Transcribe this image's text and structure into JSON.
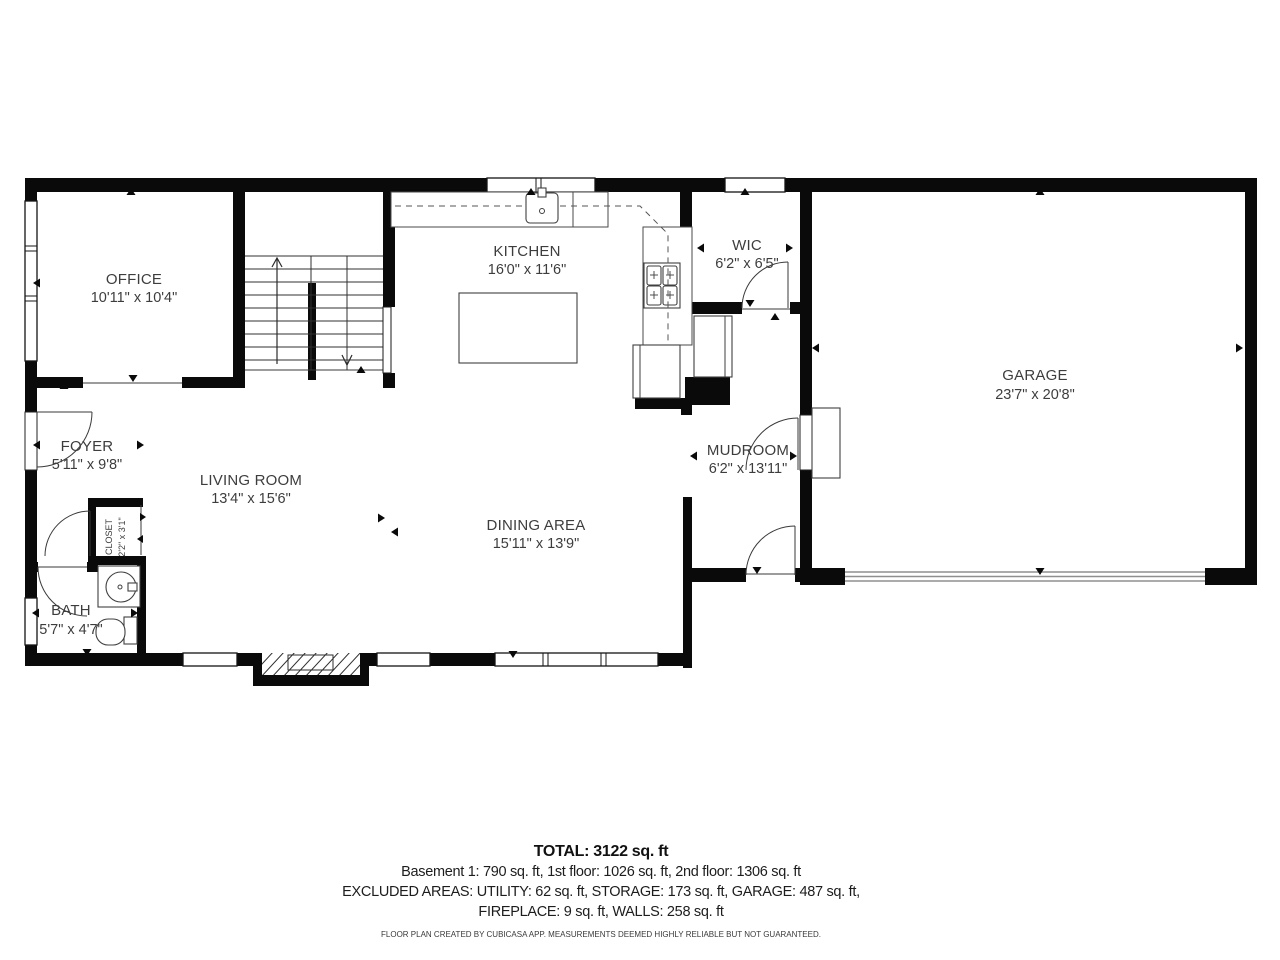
{
  "rooms": {
    "office": {
      "name": "OFFICE",
      "dims": "10'11\" x 10'4\""
    },
    "kitchen": {
      "name": "KITCHEN",
      "dims": "16'0\" x 11'6\""
    },
    "wic": {
      "name": "WIC",
      "dims": "6'2\" x 6'5\""
    },
    "garage": {
      "name": "GARAGE",
      "dims": "23'7\" x 20'8\""
    },
    "foyer": {
      "name": "FOYER",
      "dims": "5'11\" x 9'8\""
    },
    "living_room": {
      "name": "LIVING ROOM",
      "dims": "13'4\" x 15'6\""
    },
    "dining_area": {
      "name": "DINING AREA",
      "dims": "15'11\" x 13'9\""
    },
    "mudroom": {
      "name": "MUDROOM",
      "dims": "6'2\" x 13'11\""
    },
    "closet": {
      "name": "CLOSET",
      "dims": "2'2\" x 3'1\""
    },
    "bath": {
      "name": "BATH",
      "dims": "5'7\" x 4'7\""
    }
  },
  "summary": {
    "total": "TOTAL: 3122 sq. ft",
    "floors": "Basement 1: 790 sq. ft, 1st floor: 1026 sq. ft, 2nd floor: 1306 sq. ft",
    "excluded_1": "EXCLUDED AREAS: UTILITY: 62 sq. ft, STORAGE: 173 sq. ft, GARAGE: 487 sq. ft,",
    "excluded_2": "FIREPLACE: 9 sq. ft, WALLS: 258 sq. ft",
    "credit": "FLOOR PLAN CREATED BY CUBICASA APP. MEASUREMENTS DEEMED HIGHLY RELIABLE BUT NOT GUARANTEED."
  },
  "colors": {
    "wall": "#0a0a0a",
    "line": "#3a3a3a",
    "text": "#3d3d3d"
  }
}
